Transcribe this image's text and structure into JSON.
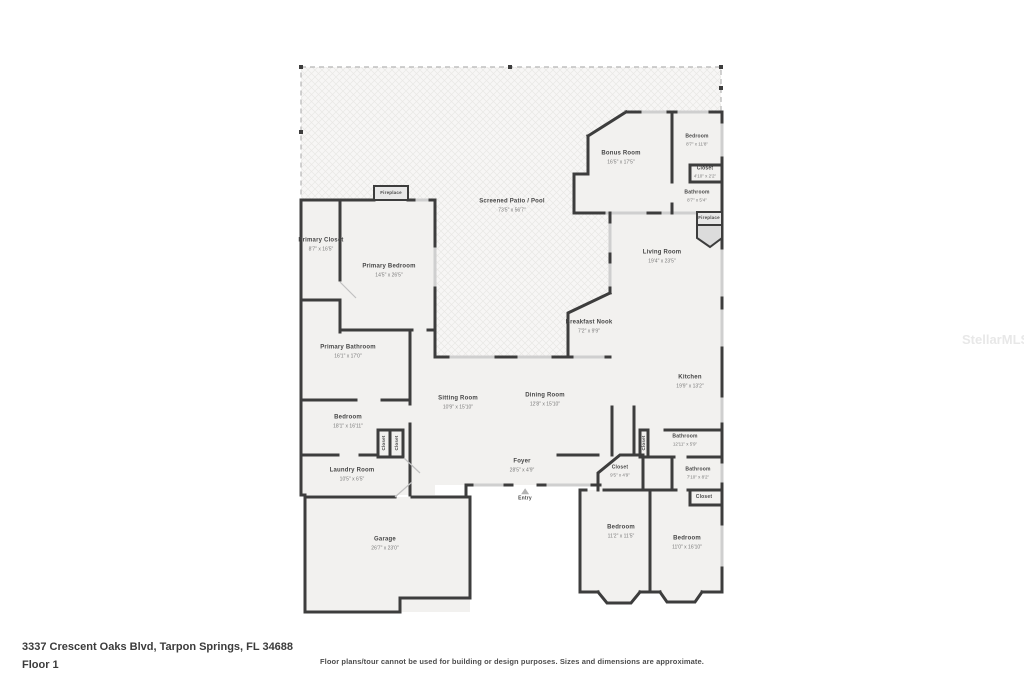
{
  "footer": {
    "address": "3337 Crescent Oaks Blvd, Tarpon Springs, FL 34688",
    "floor": "Floor 1",
    "disclaimer": "Floor plans/tour cannot be used for building or design purposes. Sizes and dimensions are approximate."
  },
  "watermark": "StellarMLS",
  "colors": {
    "wall": "#3d3d3d",
    "window": "#cfcfcf",
    "room_fill": "#f2f1ef",
    "patio_fill": "#f7f6f5",
    "label": "#4a4a4a"
  },
  "plan": {
    "rooms": [
      {
        "id": "screened-patio",
        "name": "Screened Patio / Pool",
        "dims": "73'5\" x 56'7\"",
        "x": 512,
        "y": 206,
        "style": "normal"
      },
      {
        "id": "bonus-room",
        "name": "Bonus Room",
        "dims": "16'5\" x 17'5\"",
        "x": 621,
        "y": 158,
        "style": "normal"
      },
      {
        "id": "bedroom-top-right",
        "name": "Bedroom",
        "dims": "8'7\" x 11'8\"",
        "x": 697,
        "y": 140,
        "style": "small"
      },
      {
        "id": "closet-top-right",
        "name": "Closet",
        "dims": "4'10\" x 2'2\"",
        "x": 705,
        "y": 172,
        "style": "small"
      },
      {
        "id": "bathroom-top-right",
        "name": "Bathroom",
        "dims": "8'7\" x 5'4\"",
        "x": 697,
        "y": 196,
        "style": "small"
      },
      {
        "id": "fireplace-right",
        "name": "Fireplace",
        "x": 709,
        "y": 218,
        "style": "tiny"
      },
      {
        "id": "fireplace-top",
        "name": "Fireplace",
        "x": 391,
        "y": 193,
        "style": "tiny"
      },
      {
        "id": "living-room",
        "name": "Living Room",
        "dims": "19'4\" x 23'5\"",
        "x": 662,
        "y": 257,
        "style": "normal"
      },
      {
        "id": "primary-closet",
        "name": "Primary Closet",
        "dims": "8'7\" x 16'5\"",
        "x": 321,
        "y": 245,
        "style": "normal"
      },
      {
        "id": "primary-bedroom",
        "name": "Primary Bedroom",
        "dims": "14'5\" x 26'5\"",
        "x": 389,
        "y": 271,
        "style": "normal"
      },
      {
        "id": "primary-bathroom",
        "name": "Primary Bathroom",
        "dims": "16'1\" x 17'0\"",
        "x": 348,
        "y": 352,
        "style": "normal"
      },
      {
        "id": "breakfast-nook",
        "name": "Breakfast Nook",
        "dims": "7'2\" x 9'9\"",
        "x": 589,
        "y": 327,
        "style": "normal"
      },
      {
        "id": "kitchen",
        "name": "Kitchen",
        "dims": "19'9\" x 13'2\"",
        "x": 690,
        "y": 382,
        "style": "normal"
      },
      {
        "id": "sitting-room",
        "name": "Sitting Room",
        "dims": "10'9\" x 15'10\"",
        "x": 458,
        "y": 403,
        "style": "normal"
      },
      {
        "id": "dining-room",
        "name": "Dining Room",
        "dims": "12'8\" x 15'10\"",
        "x": 545,
        "y": 400,
        "style": "normal"
      },
      {
        "id": "bedroom-left",
        "name": "Bedroom",
        "dims": "18'1\" x 16'11\"",
        "x": 348,
        "y": 422,
        "style": "normal"
      },
      {
        "id": "closet-left-1",
        "name": "Closet",
        "x": 384,
        "y": 443,
        "style": "vertical"
      },
      {
        "id": "closet-left-2",
        "name": "Closet",
        "x": 397,
        "y": 443,
        "style": "vertical"
      },
      {
        "id": "closet-mid-right",
        "name": "Closet",
        "x": 644,
        "y": 443,
        "style": "vertical"
      },
      {
        "id": "bathroom-mid",
        "name": "Bathroom",
        "dims": "12'11\" x 5'9\"",
        "x": 685,
        "y": 440,
        "style": "small"
      },
      {
        "id": "bathroom-lower",
        "name": "Bathroom",
        "dims": "7'10\" x 8'2\"",
        "x": 698,
        "y": 473,
        "style": "small"
      },
      {
        "id": "foyer",
        "name": "Foyer",
        "dims": "28'5\" x 4'9\"",
        "x": 522,
        "y": 466,
        "style": "normal"
      },
      {
        "id": "entry",
        "name": "Entry",
        "x": 525,
        "y": 495,
        "style": "small",
        "icon": "entry-triangle"
      },
      {
        "id": "closet-foyer",
        "name": "Closet",
        "dims": "9'5\" x 4'9\"",
        "x": 620,
        "y": 471,
        "style": "small"
      },
      {
        "id": "laundry-room",
        "name": "Laundry Room",
        "dims": "10'5\" x 6'5\"",
        "x": 352,
        "y": 475,
        "style": "normal"
      },
      {
        "id": "garage",
        "name": "Garage",
        "dims": "26'7\" x 23'0\"",
        "x": 385,
        "y": 544,
        "style": "normal"
      },
      {
        "id": "bedroom-bottom-left",
        "name": "Bedroom",
        "dims": "11'2\" x 11'5\"",
        "x": 621,
        "y": 532,
        "style": "normal"
      },
      {
        "id": "bedroom-bottom-right",
        "name": "Bedroom",
        "dims": "11'0\" x 16'10\"",
        "x": 687,
        "y": 543,
        "style": "normal"
      },
      {
        "id": "closet-bottom-right",
        "name": "Closet",
        "x": 704,
        "y": 497,
        "style": "small"
      }
    ]
  }
}
